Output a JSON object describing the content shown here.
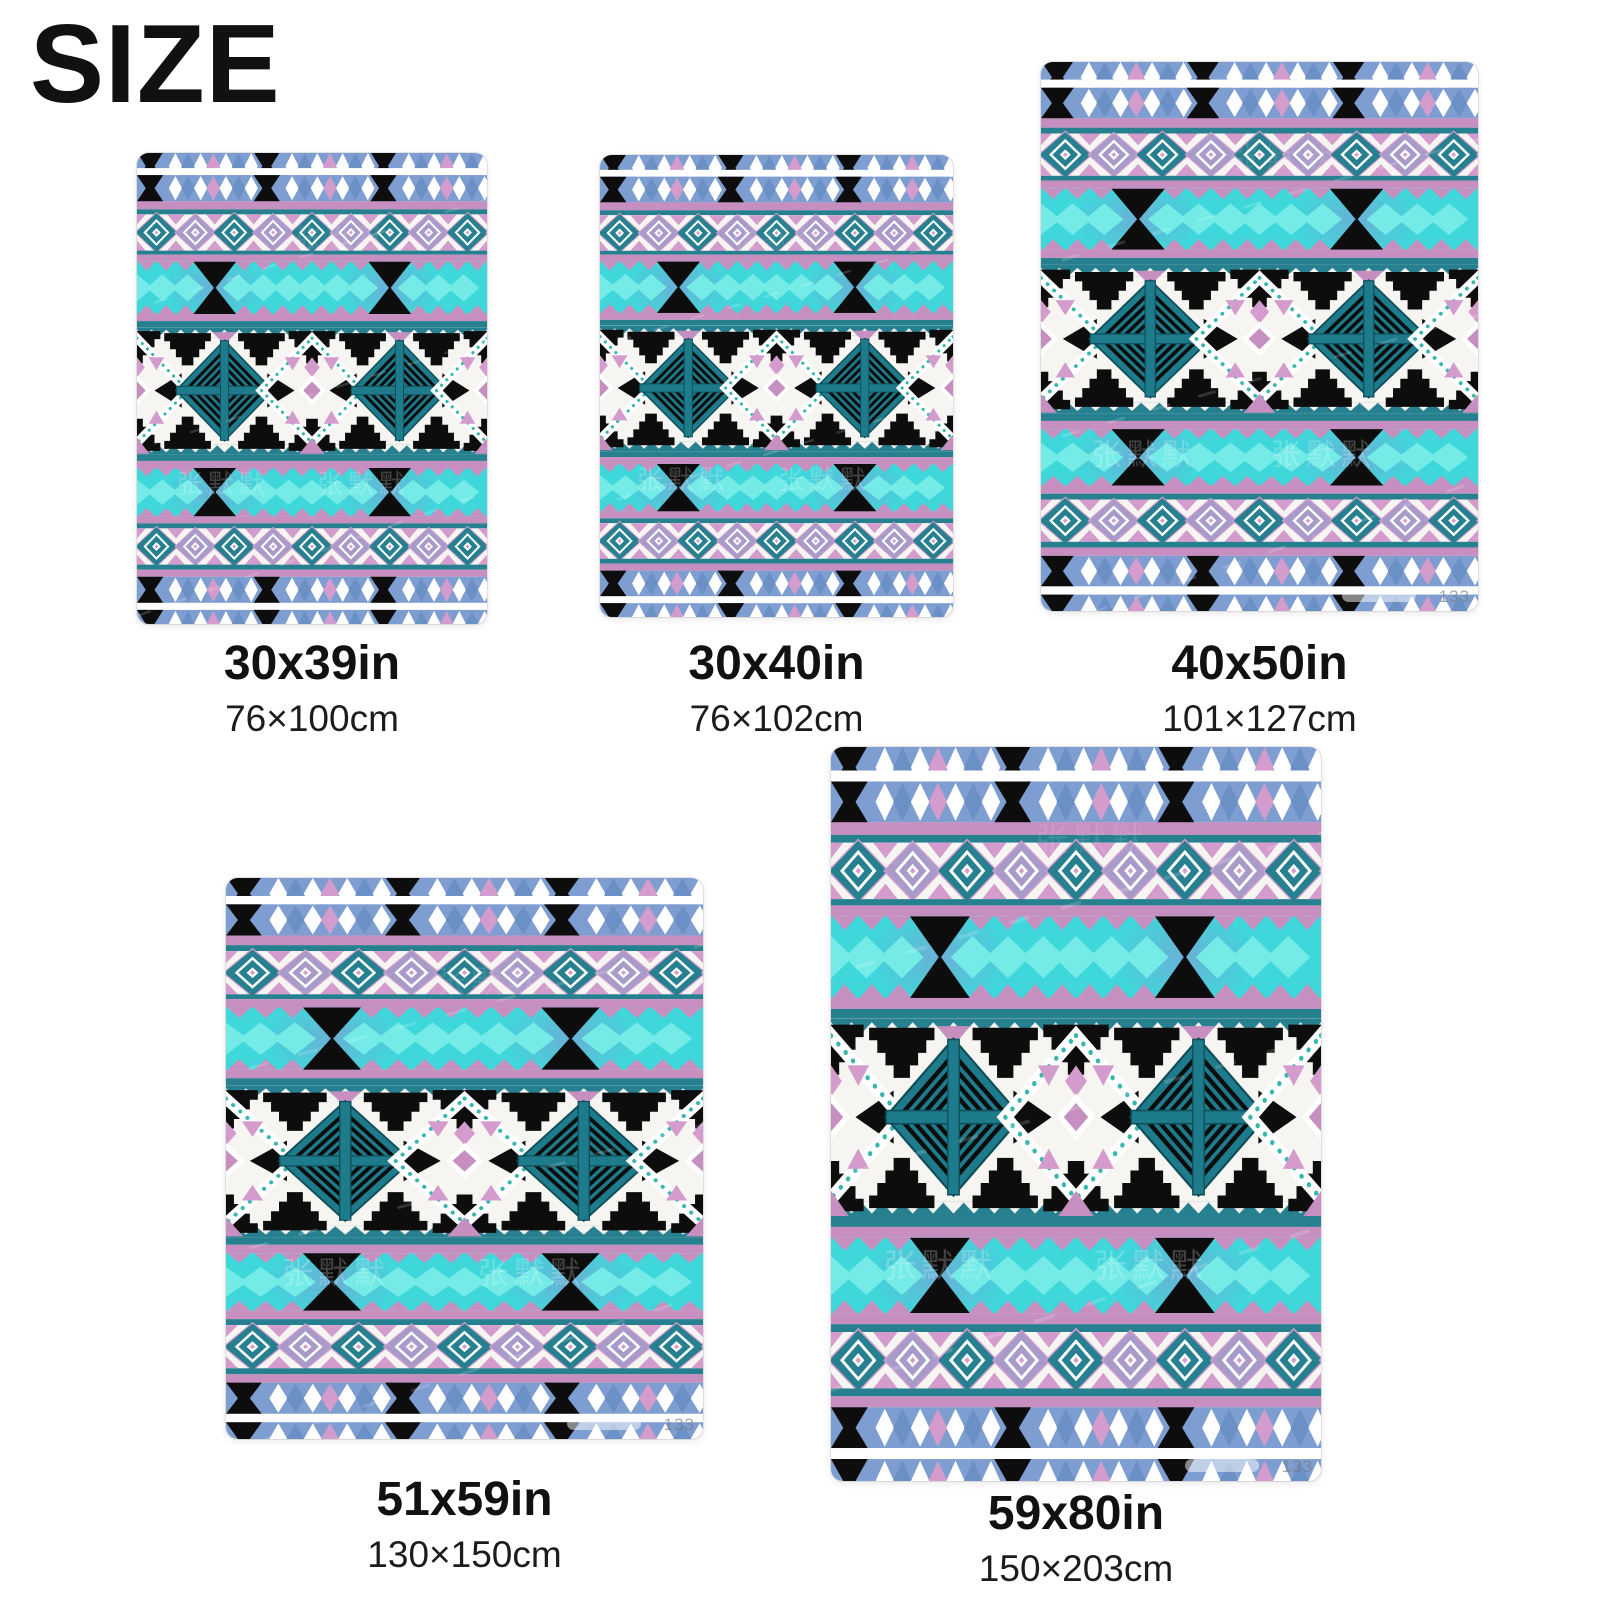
{
  "page": {
    "title": "SIZE"
  },
  "watermark": {
    "artist": "张默默",
    "corner_id": "133"
  },
  "palette": {
    "blue": "#7e9ed1",
    "blueDark": "#6b90c5",
    "black": "#0d0d0d",
    "white": "#ffffff",
    "offwhite": "#f7f5f2",
    "mauve": "#c68fc0",
    "pink": "#d49ccd",
    "lavender": "#a89bca",
    "teal": "#27808f",
    "tealMotif": "#1e7b8b",
    "tealDark": "#0e4e59",
    "cyan": "#3ed8db",
    "cyanLight": "#74ebe7",
    "chain": "#38b8ad",
    "haze": "#8f8fd0"
  },
  "sizes": [
    {
      "inches": "30x39in",
      "cm": "76×100cm"
    },
    {
      "inches": "30x40in",
      "cm": "76×102cm"
    },
    {
      "inches": "40x50in",
      "cm": "101×127cm"
    },
    {
      "inches": "51x59in",
      "cm": "130×150cm"
    },
    {
      "inches": "59x80in",
      "cm": "150×203cm"
    }
  ]
}
